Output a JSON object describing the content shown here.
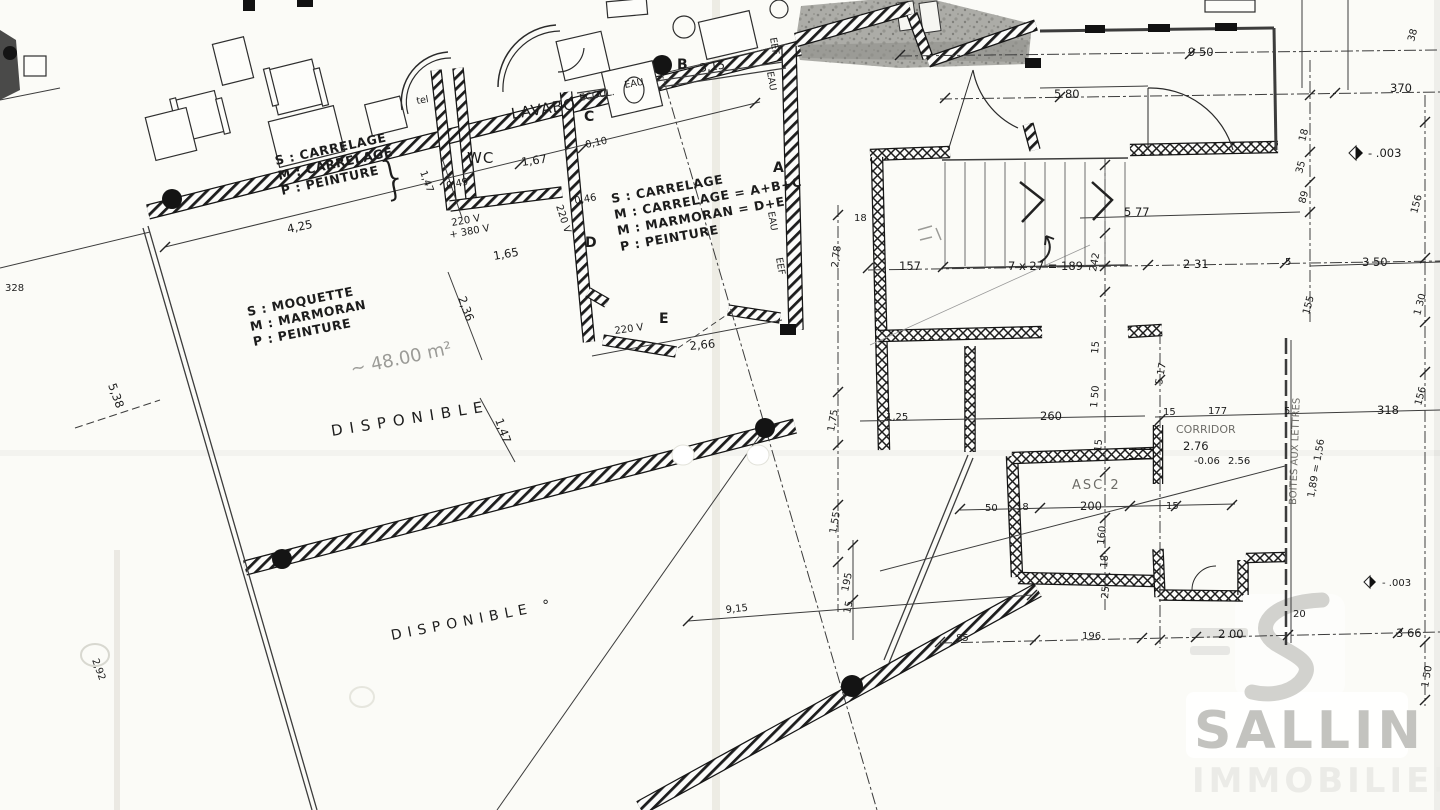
{
  "watermark": {
    "brand": "SALLIN",
    "brand_sub": "IMMOBILIER"
  },
  "rooms": {
    "lavabo": "LAVABO",
    "wc": "WC",
    "tel": "tel",
    "corridor": "CORRIDOR",
    "elevator": "ASC 2",
    "available_1": "DISPONIBLE",
    "available_2": "DISPONIBLE °",
    "area_note": "~ 48.00 m²"
  },
  "zones": {
    "a": "A",
    "b": "B",
    "c": "C",
    "d": "D",
    "e": "E"
  },
  "legend_top": {
    "l1": "S : CARRELAGE",
    "l2": "M : CARRELAGE",
    "l3": "P : PEINTURE",
    "brace": "}"
  },
  "legend_mid": {
    "l1": "S : CARRELAGE",
    "l2": "M : CARRELAGE = A+B+C",
    "l3": "M : MARMORAN = D+E",
    "l4": "P : PEINTURE"
  },
  "legend_left": {
    "l1": "S : MOQUETTE",
    "l2": "M : MARMORAN",
    "l3": "P : PEINTURE"
  },
  "annotations": {
    "ecoul": "ECOUL.",
    "eau_top": "EAU",
    "eef_v1": "EEF",
    "eau_v1": "EAU",
    "eef_v2": "EEF",
    "eau_v2": "EAU",
    "v220_wc": "220 V",
    "v380_wc": "+ 380 V",
    "v220_door": "220 V",
    "v220_e": "220 V",
    "stair_formula": "7 x 27 = 189",
    "mailboxes": "BOITES AUX LETTRES",
    "mail_note": "1,89 = 1,56",
    "level_top": "- .003",
    "level_bottom": "- .003",
    "corridor_h": "2.76",
    "corridor_l1": "-0.06",
    "corridor_l2": "2.56"
  },
  "dims": {
    "d425": "4,25",
    "d147a": "1,47",
    "d049": "0,49",
    "d167": "1,67",
    "d010": "0,10",
    "d046": "0,46",
    "d165": "1,65",
    "d315": "3,15",
    "d266": "2,66",
    "d236": "2,36",
    "d147b": "1,47",
    "d538": "5,38",
    "d328": "328",
    "d292": "2,92",
    "d278": "2,78",
    "d18a": "18",
    "d157": "157",
    "d242": "242",
    "d577": "5 77",
    "d231": "2 31",
    "d950": "9 50",
    "d580": "5 80",
    "d370": "370",
    "d38": "38",
    "d18b": "18",
    "d35": "35",
    "d89": "89",
    "d156a": "156",
    "d350": "3 50",
    "d130": "1 30",
    "d155a": "155",
    "d5a": "5",
    "d318": "318",
    "d156b": "156",
    "d177": "177",
    "d15a": "15",
    "d5b": "5",
    "d200a": "200",
    "d160": "160",
    "d18c": "18",
    "d25": "25",
    "d15b": "15",
    "d15c": "15",
    "d18d": "18",
    "d50": "50",
    "d15d": "15",
    "d260": "260",
    "d150a": "1 50",
    "d517": "5 17",
    "d195": "195",
    "d15e": "15",
    "d85": "85",
    "d196": "196",
    "d200b": "2 00",
    "d20": "20",
    "d366": "3 66",
    "d150b": "1 50",
    "d915": "9,15",
    "d175": "1,75",
    "d125": "1,25",
    "d155b": "1,55"
  }
}
